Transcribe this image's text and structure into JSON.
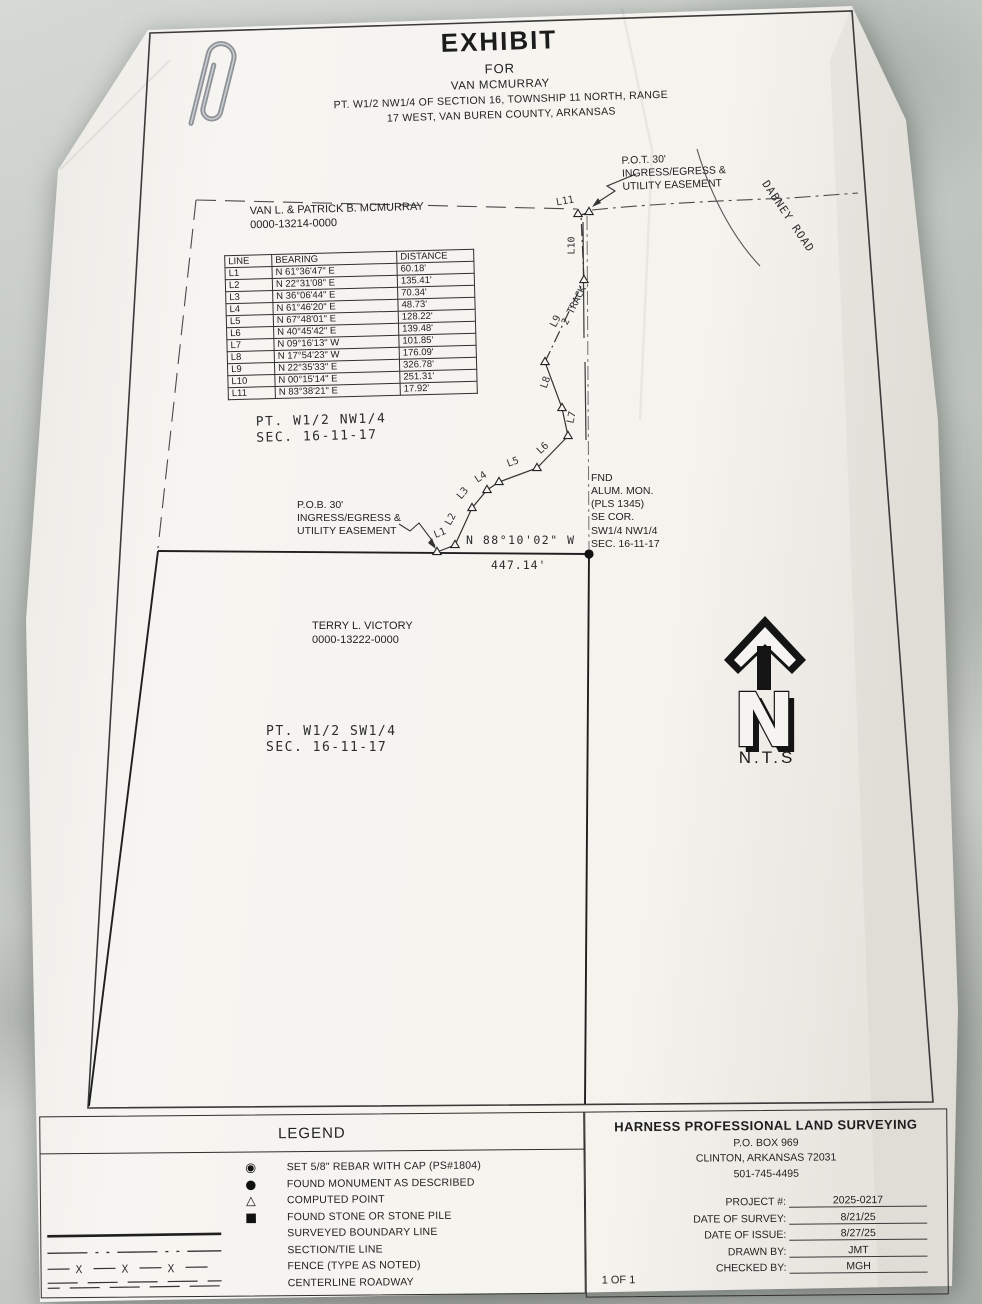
{
  "sheet_title": {
    "main": "EXHIBIT",
    "for": "FOR",
    "client": "VAN MCMURRAY",
    "desc1": "PT. W1/2 NW1/4 OF SECTION 16, TOWNSHIP 11 NORTH, RANGE",
    "desc2": "17 WEST, VAN BUREN COUNTY, ARKANSAS"
  },
  "owners": {
    "mcmurray": "VAN L. & PATRICK B. MCMURRAY\n0000-13214-0000",
    "victory": "TERRY L. VICTORY\n0000-13222-0000"
  },
  "areas": {
    "nw": "PT. W1/2 NW1/4\nSEC. 16-11-17",
    "sw": "PT. W1/2 SW1/4\nSEC. 16-11-17"
  },
  "notes": {
    "pot": "P.O.T. 30'\nINGRESS/EGRESS &\nUTILITY EASEMENT",
    "pob": "P.O.B. 30'\nINGRESS/EGRESS &\nUTILITY EASEMENT",
    "fnd": "FND\nALUM. MON.\n(PLS 1345)\nSE COR.\nSW1/4 NW1/4\nSEC. 16-11-17"
  },
  "road": {
    "name": "DABNEY ROAD",
    "track": "2 TRACK"
  },
  "dimension": {
    "bearing": "N 88°10'02\" W",
    "distance": "447.14'"
  },
  "north_arrow": {
    "letter": "N",
    "nts": "N.T.S"
  },
  "line_table": {
    "headers": [
      "LINE",
      "BEARING",
      "DISTANCE"
    ],
    "rows": [
      {
        "line": "L1",
        "bearing": "N 61°36'47\" E",
        "distance": "60.18'"
      },
      {
        "line": "L2",
        "bearing": "N 22°31'08\" E",
        "distance": "135.41'"
      },
      {
        "line": "L3",
        "bearing": "N 36°06'44\" E",
        "distance": "70.34'"
      },
      {
        "line": "L4",
        "bearing": "N 61°46'20\" E",
        "distance": "48.73'"
      },
      {
        "line": "L5",
        "bearing": "N 67°48'01\" E",
        "distance": "128.22'"
      },
      {
        "line": "L6",
        "bearing": "N 40°45'42\" E",
        "distance": "139.48'"
      },
      {
        "line": "L7",
        "bearing": "N 09°16'13\" W",
        "distance": "101.85'"
      },
      {
        "line": "L8",
        "bearing": "N 17°54'23\" W",
        "distance": "176.09'"
      },
      {
        "line": "L9",
        "bearing": "N 22°35'33\" E",
        "distance": "326.78'"
      },
      {
        "line": "L10",
        "bearing": "N 00°15'14\" E",
        "distance": "251.31'"
      },
      {
        "line": "L11",
        "bearing": "N 83°38'21\" E",
        "distance": "17.92'"
      }
    ]
  },
  "traverse": {
    "labels": [
      "L1",
      "L2",
      "L3",
      "L4",
      "L5",
      "L6",
      "L7",
      "L8",
      "L9",
      "L10",
      "L11"
    ]
  },
  "legend": {
    "title": "LEGEND",
    "fence_x": "X",
    "items": [
      {
        "symbol": "set-rebar-icon",
        "glyph": "◉",
        "label": "SET 5/8\" REBAR WITH CAP (PS#1804)"
      },
      {
        "symbol": "found-monument-icon",
        "glyph": "●",
        "label": "FOUND MONUMENT AS DESCRIBED"
      },
      {
        "symbol": "computed-point-icon",
        "glyph": "△",
        "label": "COMPUTED POINT"
      },
      {
        "symbol": "found-stone-icon",
        "glyph": "■",
        "label": "FOUND STONE OR STONE PILE"
      },
      {
        "symbol": "surveyed-boundary-line-sample",
        "glyph": "",
        "label": "SURVEYED BOUNDARY LINE"
      },
      {
        "symbol": "section-tie-line-sample",
        "glyph": "",
        "label": "SECTION/TIE LINE"
      },
      {
        "symbol": "fence-line-sample",
        "glyph": "",
        "label": "FENCE (TYPE AS NOTED)"
      },
      {
        "symbol": "centerline-roadway-sample",
        "glyph": "",
        "label": "CENTERLINE ROADWAY"
      }
    ]
  },
  "surveyor": {
    "company": "HARNESS PROFESSIONAL LAND SURVEYING",
    "address1": "P.O. BOX 969",
    "address2": "CLINTON, ARKANSAS 72031",
    "phone": "501-745-4495",
    "fields": [
      {
        "label": "PROJECT #:",
        "value": "2025-0217"
      },
      {
        "label": "DATE OF SURVEY:",
        "value": "8/21/25"
      },
      {
        "label": "DATE OF ISSUE:",
        "value": "8/27/25"
      },
      {
        "label": "DRAWN BY:",
        "value": "JMT"
      },
      {
        "label": "CHECKED BY:",
        "value": "MGH"
      }
    ],
    "sheet": "1 OF 1"
  }
}
